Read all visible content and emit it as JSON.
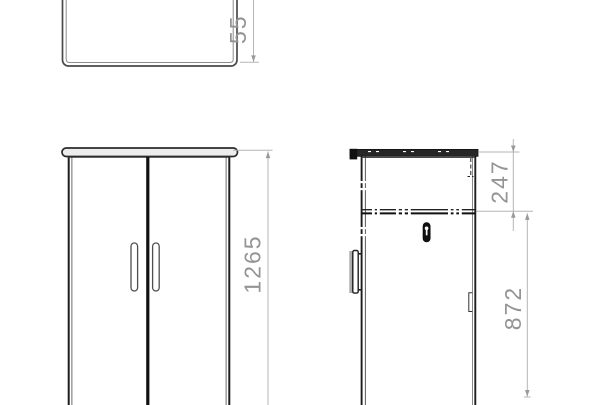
{
  "dimensions": {
    "plan_depth": "55",
    "overall_height": "1265",
    "upper_section": "247",
    "lower_section": "872"
  },
  "icons": {
    "keyhole": "lock-keyhole"
  },
  "colors": {
    "background": "#ffffff",
    "outline": "#1d1d1d",
    "dimension_line": "#b5b5b5",
    "dimension_text": "#949494"
  }
}
